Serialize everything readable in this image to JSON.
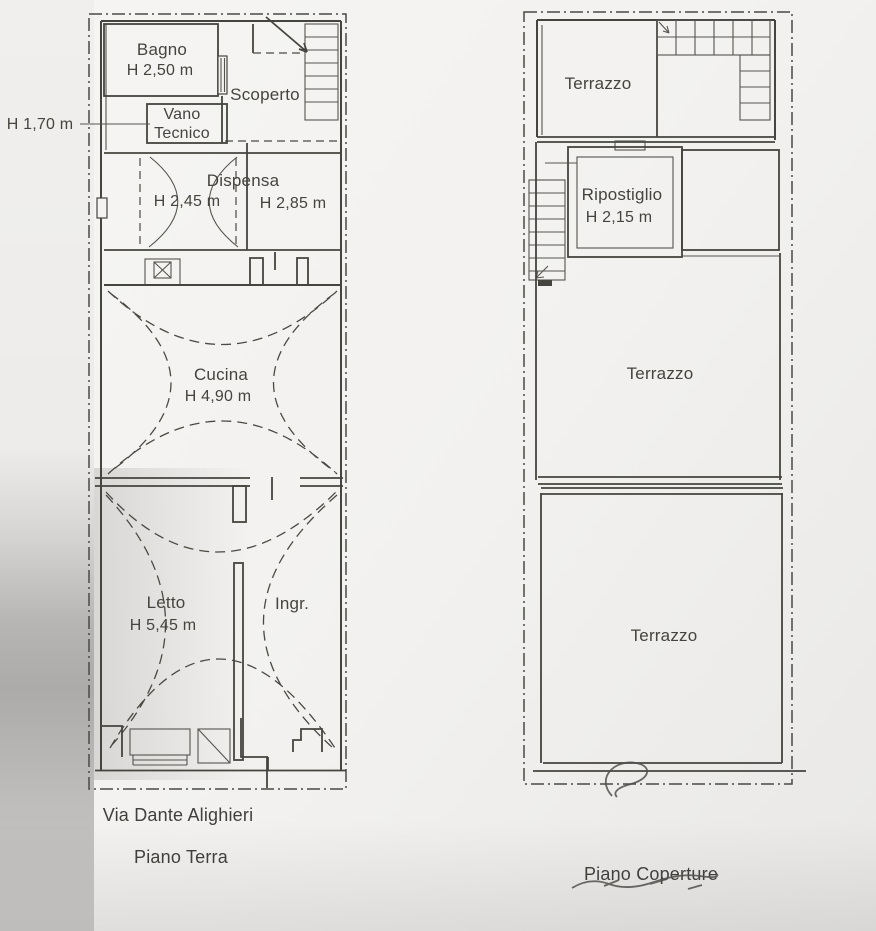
{
  "document": {
    "kind": "scanned floor plan"
  },
  "colors": {
    "ink": "#45443f",
    "paper": "#f2f1ef",
    "shadow": "#adabaa"
  },
  "left_plan": {
    "captions": {
      "street": "Via Dante Alighieri",
      "floor": "Piano Terra"
    },
    "annotations": {
      "external_height": "H 1,70 m"
    },
    "rooms": {
      "bagno": {
        "label": "Bagno",
        "height": "H 2,50 m"
      },
      "scoperto": {
        "label": "Scoperto"
      },
      "vano_tecnico": {
        "label_line1": "Vano",
        "label_line2": "Tecnico"
      },
      "dispensa": {
        "label": "Dispensa",
        "height_left": "H 2,45 m",
        "height_right": "H 2,85 m"
      },
      "cucina": {
        "label": "Cucina",
        "height": "H 4,90 m"
      },
      "letto": {
        "label": "Letto",
        "height": "H 5,45 m"
      },
      "ingresso": {
        "label": "Ingr."
      }
    }
  },
  "right_plan": {
    "captions": {
      "floor": "Piano Coperture"
    },
    "rooms": {
      "terrazzo_top": {
        "label": "Terrazzo"
      },
      "ripostiglio": {
        "label": "Ripostiglio",
        "height": "H 2,15 m"
      },
      "terrazzo_middle": {
        "label": "Terrazzo"
      },
      "terrazzo_bottom": {
        "label": "Terrazzo"
      }
    }
  }
}
